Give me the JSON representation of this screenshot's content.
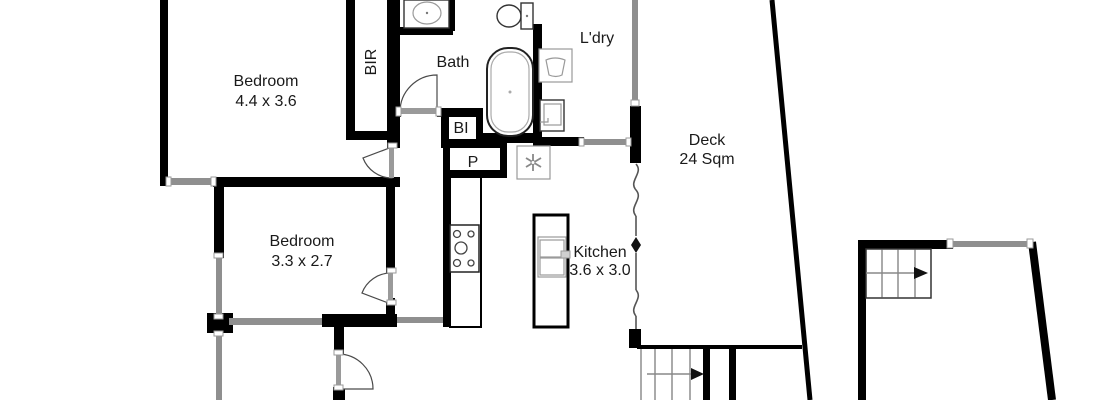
{
  "floorplan": {
    "background": "#ffffff",
    "wall_color": "#000000",
    "window_color": "#8f8f8f",
    "rooms": {
      "bedroom1": {
        "label": "Bedroom",
        "dims": "4.4 x 3.6"
      },
      "bedroom2": {
        "label": "Bedroom",
        "dims": "3.3 x 2.7"
      },
      "bath": {
        "label": "Bath"
      },
      "laundry": {
        "label": "L'dry"
      },
      "deck": {
        "label": "Deck",
        "dims": "24 Sqm"
      },
      "kitchen": {
        "label": "Kitchen",
        "dims": "3.6 x 3.0"
      },
      "robe": {
        "label": "BIR"
      },
      "builtin": {
        "label": "BI"
      },
      "pantry": {
        "label": "P"
      }
    }
  }
}
